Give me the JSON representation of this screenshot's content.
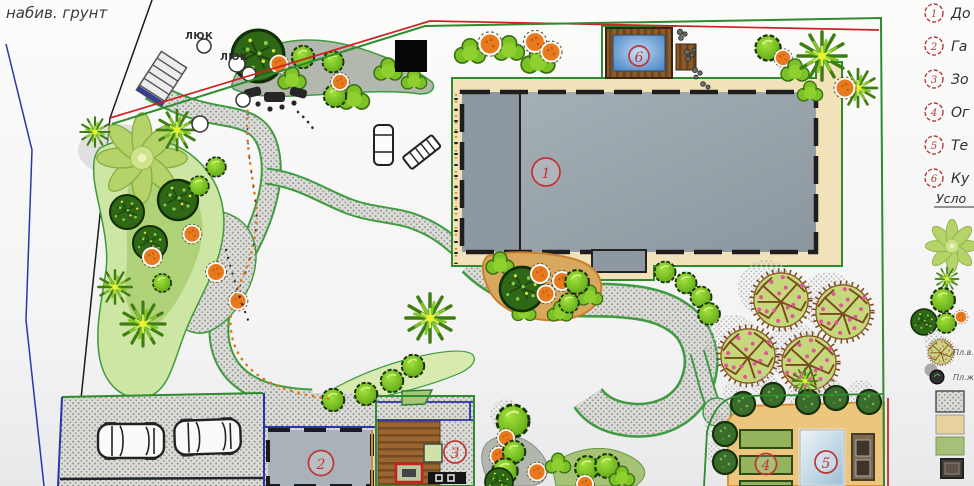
{
  "plan": {
    "soil_note": "набив. грунт",
    "manhole_labels": [
      "ЛЮК",
      "ЛЮК"
    ],
    "markers": {
      "house": "1",
      "garage": "2",
      "patio": "3",
      "vegetable_garden": "4",
      "greenhouse": "5",
      "pool": "6"
    }
  },
  "legend": {
    "items": [
      {
        "num": "1",
        "label": "До"
      },
      {
        "num": "2",
        "label": "Га"
      },
      {
        "num": "3",
        "label": "Зо"
      },
      {
        "num": "4",
        "label": "Ог"
      },
      {
        "num": "5",
        "label": "Те"
      },
      {
        "num": "6",
        "label": "Ку"
      }
    ],
    "symbols_title": "Усло",
    "plant_labels": [
      {
        "label": "Пл.в."
      },
      {
        "label": "Пл.ж"
      }
    ],
    "symbol_icons": [
      "palm-tree-icon",
      "spiky-plant-icon",
      "green-tree-icon",
      "dark-tree-icon",
      "orange-shrub-icon",
      "fruit-tree-icon",
      "small-plant-icon",
      "paving-swatch",
      "sand-swatch",
      "lawn-swatch",
      "timber-swatch"
    ]
  },
  "colors": {
    "paving": "#dbdbd8",
    "house_gray": "#9aa5ad",
    "apron_beige": "#f1e2ba",
    "pool_blue": "#4a84c4",
    "garden_tan": "#ecc67c",
    "lawn_green": "#cde6a3",
    "tree_green": "#6cbf1e",
    "shrub_orange": "#e8791d",
    "fruit_tree": "#c6d87c",
    "marker_red": "#c23434",
    "boundary_green": "#2e8b2e",
    "boundary_red": "#cc2222",
    "boundary_blue": "#2a35a8"
  }
}
